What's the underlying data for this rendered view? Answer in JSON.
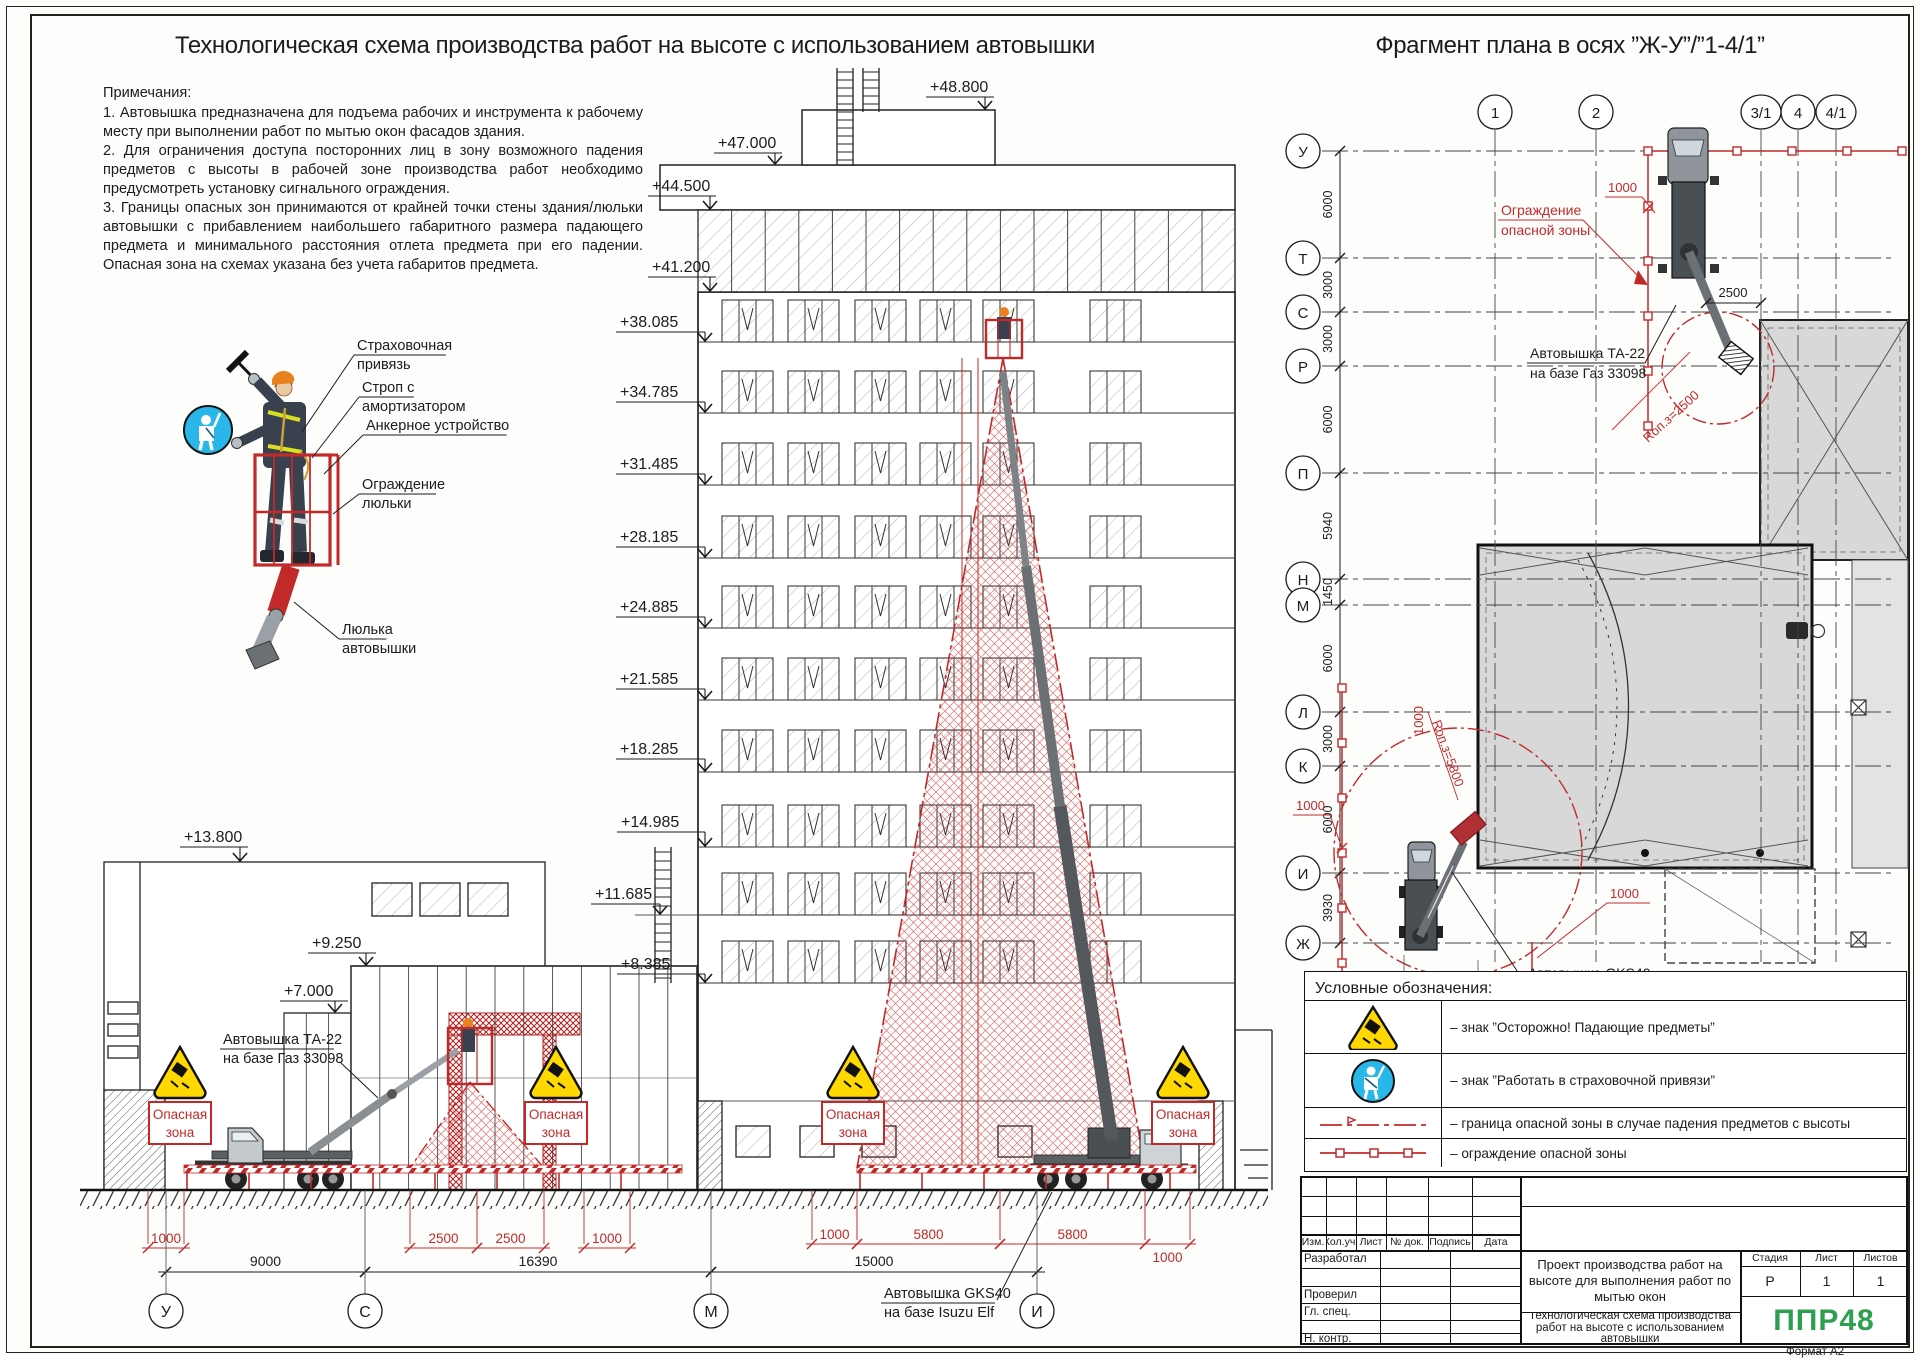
{
  "sheet": {
    "format_note": "Формат А2"
  },
  "titles": {
    "left": "Технологическая схема производства работ на высоте с использованием автовышки",
    "right": "Фрагмент плана в осях ”Ж-У”/”1-4/1”"
  },
  "notes": {
    "heading": "Примечания:",
    "items": [
      "1.  Автовышка предназначена для подъема рабочих и инструмента к рабочему месту при выполнении работ по мытью окон фасадов здания.",
      "2. Для ограничения доступа посторонних лиц в зону возможного падения предметов с высоты в рабочей зоне производства работ необходимо предусмотреть установку сигнального ограждения.",
      "3. Границы опасных зон принимаются от крайней точки стены здания/люльки автовышки с прибавлением наибольшего габаритного размера падающего предмета и минимального расстояния отлета предмета при его падении. Опасная зона на схемах указана без учета габаритов предмета."
    ]
  },
  "callouts": [
    {
      "lines": [
        "Страховочная",
        "привязь"
      ],
      "x": 357,
      "y": 350,
      "tx": 302,
      "ty": 432
    },
    {
      "lines": [
        "Строп с",
        "амортизатором"
      ],
      "x": 362,
      "y": 392,
      "tx": 312,
      "ty": 458
    },
    {
      "lines": [
        "Анкерное устройство"
      ],
      "x": 366,
      "y": 430,
      "tx": 324,
      "ty": 474
    },
    {
      "lines": [
        "Ограждение",
        "люльки"
      ],
      "x": 362,
      "y": 489,
      "tx": 333,
      "ty": 514
    },
    {
      "lines": [
        "Люлька",
        "автовышки"
      ],
      "x": 342,
      "y": 634,
      "tx": 294,
      "ty": 602
    }
  ],
  "elevation": {
    "marks": [
      {
        "t": "+48.800",
        "x": 930,
        "y": 92,
        "ax": 985,
        "ay": 110
      },
      {
        "t": "+47.000",
        "x": 718,
        "y": 148,
        "ax": 775,
        "ay": 165
      },
      {
        "t": "+44.500",
        "x": 652,
        "y": 191,
        "ax": 710,
        "ay": 210
      },
      {
        "t": "+41.200",
        "x": 652,
        "y": 272,
        "ax": 710,
        "ay": 292
      },
      {
        "t": "+38.085",
        "x": 620,
        "y": 327,
        "ax": 705,
        "ay": 342
      },
      {
        "t": "+34.785",
        "x": 620,
        "y": 397,
        "ax": 705,
        "ay": 413
      },
      {
        "t": "+31.485",
        "x": 620,
        "y": 469,
        "ax": 705,
        "ay": 485
      },
      {
        "t": "+28.185",
        "x": 620,
        "y": 542,
        "ax": 705,
        "ay": 558
      },
      {
        "t": "+24.885",
        "x": 620,
        "y": 612,
        "ax": 705,
        "ay": 628
      },
      {
        "t": "+21.585",
        "x": 620,
        "y": 684,
        "ax": 705,
        "ay": 700
      },
      {
        "t": "+18.285",
        "x": 620,
        "y": 754,
        "ax": 705,
        "ay": 772
      },
      {
        "t": "+14.985",
        "x": 621,
        "y": 827,
        "ax": 705,
        "ay": 847
      },
      {
        "t": "+11.685",
        "x": 595,
        "y": 899,
        "ax": 660,
        "ay": 915
      },
      {
        "t": "+8.385",
        "x": 621,
        "y": 969,
        "ax": 705,
        "ay": 983
      },
      {
        "t": "+13.800",
        "x": 184,
        "y": 842,
        "ax": 240,
        "ay": 862
      },
      {
        "t": "+9.250",
        "x": 312,
        "y": 948,
        "ax": 366,
        "ay": 966
      },
      {
        "t": "+7.000",
        "x": 284,
        "y": 996,
        "ax": 335,
        "ay": 1013
      }
    ],
    "machines": [
      {
        "lines": [
          "Автовышка ТА-22",
          "на базе Газ 33098"
        ],
        "x": 223,
        "y": 1044,
        "lead": [
          340,
          1062,
          378,
          1098
        ]
      },
      {
        "lines": [
          "Автовышка GKS40",
          "на базе Isuzu Elf"
        ],
        "x": 884,
        "y": 1298,
        "lead": [
          997,
          1300,
          1052,
          1192
        ]
      }
    ],
    "danger_sign_lines": [
      "Опасная",
      "зона"
    ],
    "danger_positions": [
      180,
      556,
      853,
      1183
    ],
    "dims_red": [
      {
        "v": "1000",
        "x1": 148,
        "x2": 184,
        "y": 1248
      },
      {
        "v": "2500",
        "x1": 410,
        "x2": 477,
        "y": 1248
      },
      {
        "v": "2500",
        "x1": 477,
        "x2": 544,
        "y": 1248
      },
      {
        "v": "1000",
        "x1": 584,
        "x2": 630,
        "y": 1248
      },
      {
        "v": "1000",
        "x1": 812,
        "x2": 857,
        "y": 1244
      },
      {
        "v": "5800",
        "x1": 857,
        "x2": 1000,
        "y": 1244
      },
      {
        "v": "5800",
        "x1": 1000,
        "x2": 1145,
        "y": 1244
      },
      {
        "v": "1000",
        "x1": 1145,
        "x2": 1190,
        "y": 1244,
        "below": true
      }
    ],
    "dims_black": [
      {
        "v": "9000",
        "x1": 166,
        "x2": 365,
        "y": 1272
      },
      {
        "v": "16390",
        "x1": 365,
        "x2": 711,
        "y": 1272
      },
      {
        "v": "15000",
        "x1": 711,
        "x2": 1037,
        "y": 1272
      }
    ],
    "axes": [
      {
        "l": "У",
        "x": 166
      },
      {
        "l": "С",
        "x": 365
      },
      {
        "l": "М",
        "x": 711
      },
      {
        "l": "И",
        "x": 1037
      }
    ],
    "window_lines": [
      342,
      413,
      485,
      558,
      628,
      700,
      772,
      847,
      915,
      983
    ],
    "window_groups": [
      722,
      788,
      855,
      920,
      983,
      1090
    ]
  },
  "plan": {
    "row_axes": [
      {
        "l": "У",
        "y": 151
      },
      {
        "l": "Т",
        "y": 258
      },
      {
        "l": "С",
        "y": 312
      },
      {
        "l": "Р",
        "y": 366
      },
      {
        "l": "П",
        "y": 473
      },
      {
        "l": "Н",
        "y": 579
      },
      {
        "l": "М",
        "y": 605
      },
      {
        "l": "Л",
        "y": 712
      },
      {
        "l": "К",
        "y": 766
      },
      {
        "l": "И",
        "y": 873
      },
      {
        "l": "Ж",
        "y": 943
      }
    ],
    "row_dims": [
      "6000",
      "3000",
      "3000",
      "6000",
      "5940",
      "1450",
      "6000",
      "3000",
      "6000",
      "3930"
    ],
    "col_axes": [
      {
        "l": "1",
        "x": 1495
      },
      {
        "l": "2",
        "x": 1596
      },
      {
        "l": "3/1",
        "x": 1761
      },
      {
        "l": "4",
        "x": 1798
      },
      {
        "l": "4/1",
        "x": 1836
      }
    ],
    "labels": {
      "fence": [
        "Ограждение",
        "опасной зоны"
      ],
      "ta22": [
        "Автовышка ТА-22",
        "на базе Газ 33098"
      ],
      "gks40": [
        "Автовышка GKS40",
        "на базе Isuzu Elf"
      ],
      "r_ta22": "Rоп.з=2500",
      "r_gks40": "Rоп.з=5800",
      "d1000": "1000",
      "d2500": "2500"
    }
  },
  "legend": {
    "title": "Условные обозначения:",
    "rows": [
      {
        "icon": "falling-objects-sign",
        "text": "– знак ”Осторожно! Падающие предметы”"
      },
      {
        "icon": "safety-harness-sign",
        "text": "– знак ”Работать в страховочной привязи”"
      },
      {
        "icon": "danger-boundary-line",
        "text": "– граница опасной зоны в случае падения предметов с высоты"
      },
      {
        "icon": "danger-fence-line",
        "text": "– ограждение опасной зоны"
      }
    ]
  },
  "titleblock": {
    "header_cols": [
      "Изм.",
      "Кол.уч.",
      "Лист",
      "№ док.",
      "Подпись",
      "Дата"
    ],
    "roles": [
      "Разработал",
      "Проверил",
      "Гл. спец.",
      "Н. контр."
    ],
    "doc_title": "Проект производства работ на высоте для выполнения работ по мытью окон",
    "sheet_title": "Технологическая схема производства работ на высоте с использованием автовышки",
    "stage_label": "Стадия",
    "sheet_label": "Лист",
    "sheets_label": "Листов",
    "stage": "Р",
    "sheet": "1",
    "sheets": "1",
    "logo": "ППР48"
  }
}
